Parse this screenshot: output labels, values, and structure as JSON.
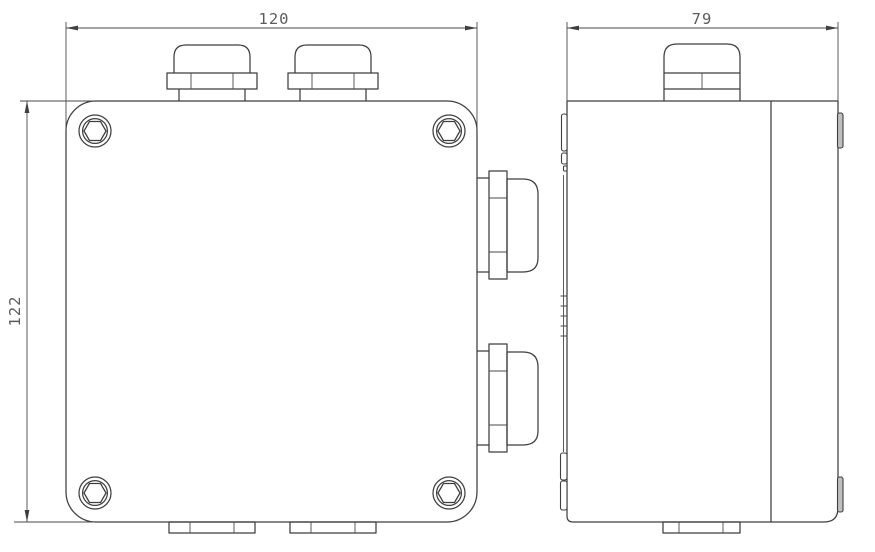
{
  "drawing": {
    "line_color": "#3f3f3f",
    "text_color": "#5c5c5c",
    "background_color": "#ffffff",
    "front_view": {
      "width_label": "120",
      "height_label": "122"
    },
    "side_view": {
      "depth_label": "79"
    }
  }
}
